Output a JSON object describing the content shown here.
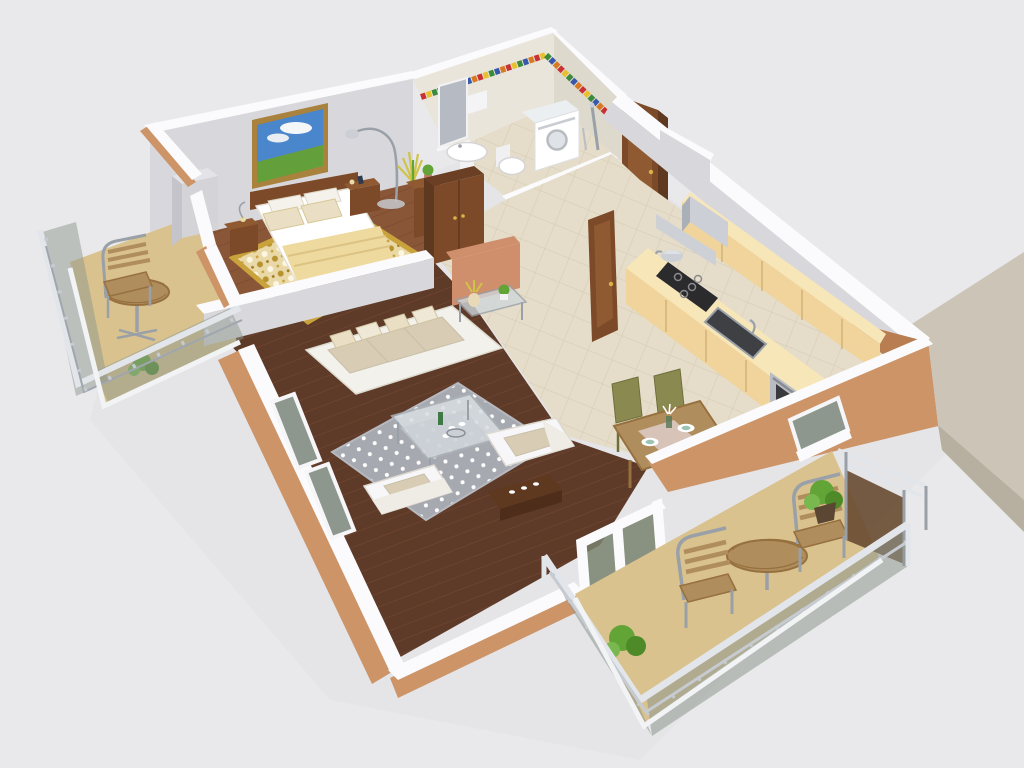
{
  "meta": {
    "title": "3D apartment floor plan cutaway render",
    "view": "isometric perspective from above",
    "visible_text": "none"
  },
  "palette": {
    "background": "#e9e9ec",
    "building_shadow": "#dcdce1",
    "ledge_top": "#ccc5b7",
    "ledge_side": "#b7afa0",
    "wall_top": "#fbfbfd",
    "wall_interior": "#d8d8dc",
    "wall_interior_dark": "#c8c8ce",
    "wall_exterior_tan": "#cd9468",
    "wall_exterior_dark": "#b87e52",
    "wall_salmon": "#d08f6c",
    "bathroom_wall": "#eae5da",
    "floor_tile": "#e5ddc9",
    "floor_wood_bedroom": "#8a5638",
    "floor_wood_living": "#5e3a28",
    "balcony_floor": "#d9c28e",
    "rug_gold_base": "#ead9a8",
    "rug_gold": "#b8922e",
    "rug_gray": "#a7a9b0",
    "sofa_frame": "#f3f1ec",
    "cushion": "#d8cdb4",
    "pillow": "#eadfc4",
    "furniture_wood": "#7c4a28",
    "kitchen_cabinet": "#f0d49c",
    "counter_top": "#f7e6b8",
    "steel": "#9aa0a8",
    "steel_light": "#ccd0d6",
    "appliance_white": "#f7f7f9",
    "hob_black": "#2b2b2e",
    "oven_steel": "#b9bcc2",
    "glass_panel": "#8e978e",
    "rail_silver": "#e2e5ea",
    "plant_green": "#63a437",
    "plant_yellow": "#cfc348",
    "table_wood": "#b08d5c",
    "chair_olive": "#8a8a50",
    "blanket": "#eeda9f",
    "painting_sky": "#4a86cc",
    "painting_grass": "#63a03c",
    "painting_frame": "#a9823e",
    "tile_red": "#c83232",
    "tile_yellow": "#e6c02e",
    "tile_green": "#3c8a3c",
    "tile_blue": "#3858aa",
    "tile_orange": "#d87820"
  },
  "rooms": [
    {
      "name": "bedroom",
      "furniture": [
        "double-bed",
        "headboard",
        "nightstand-left",
        "nightstand-right",
        "table-lamps",
        "floor-lamp",
        "ornamental-gold-rug",
        "wall-painting",
        "wardrobe",
        "gray-dresser",
        "side-cabinet",
        "potted-plants"
      ]
    },
    {
      "name": "bathroom",
      "furniture": [
        "washing-machine",
        "toilet",
        "pedestal-sink",
        "mirror",
        "towel",
        "shower-column",
        "mosaic-tile-border"
      ]
    },
    {
      "name": "hallway",
      "furniture": [
        "entry-door",
        "open-interior-door",
        "tile-floor"
      ]
    },
    {
      "name": "kitchen",
      "furniture": [
        "upper-cabinets",
        "extractor-hood",
        "gas-hob",
        "kettle",
        "kitchen-sink",
        "oven",
        "lower-cabinets"
      ]
    },
    {
      "name": "dining-area",
      "furniture": [
        "dining-table",
        "table-runner",
        "plates",
        "vase-with-flowers",
        "chair",
        "chair"
      ]
    },
    {
      "name": "living-room",
      "furniture": [
        "three-seat-sofa",
        "throw-pillows",
        "glass-coffee-table",
        "armchair",
        "armchair",
        "polka-dot-rug",
        "glass-side-table",
        "flower-vase",
        "console-shelf"
      ]
    },
    {
      "name": "balcony-left",
      "furniture": [
        "round-bistro-table",
        "metal-chair",
        "plant",
        "glass-railing"
      ]
    },
    {
      "name": "terrace-right",
      "furniture": [
        "round-table",
        "metal-chair",
        "metal-chair",
        "shrub-planters",
        "glass-railing",
        "privacy-screen"
      ]
    }
  ]
}
